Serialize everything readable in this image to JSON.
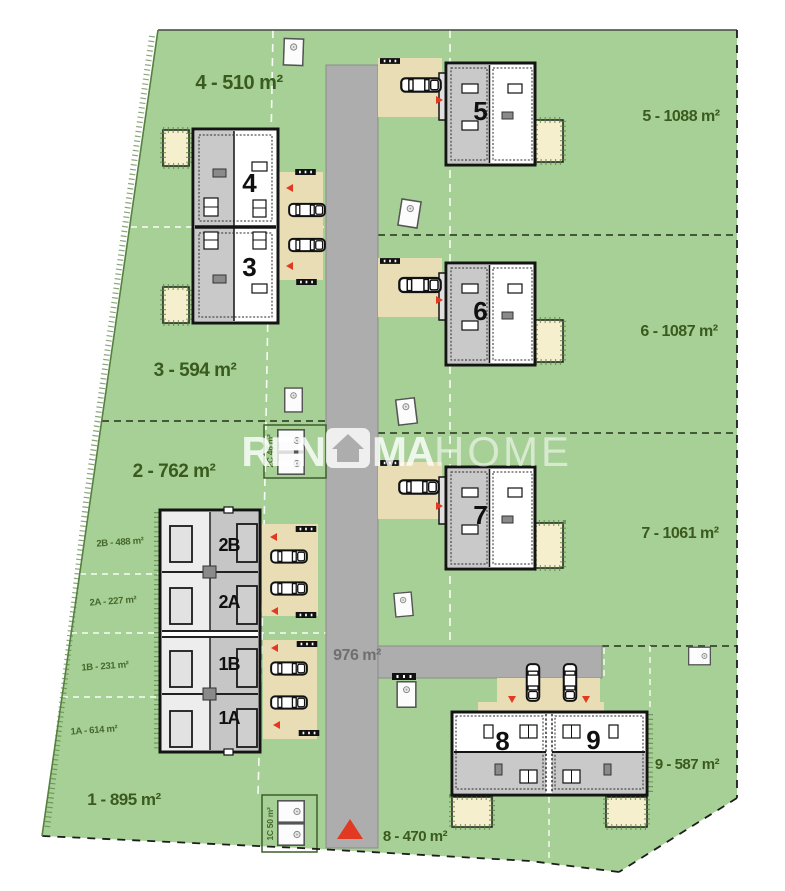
{
  "site": {
    "plots": {
      "p1": {
        "label": "1 - 895 m²"
      },
      "p2": {
        "label": "2 - 762 m²"
      },
      "p3": {
        "label": "3 - 594 m²"
      },
      "p4": {
        "label": "4 - 510 m²"
      },
      "p5": {
        "label": "5 - 1088 m²"
      },
      "p6": {
        "label": "6 - 1087 m²"
      },
      "p7": {
        "label": "7 - 1061 m²"
      },
      "p8": {
        "label": "8 - 470 m²"
      },
      "p9": {
        "label": "9 - 587 m²"
      }
    },
    "subplots": {
      "s2B": {
        "label": "2B - 488 m²"
      },
      "s2A": {
        "label": "2A - 227 m²"
      },
      "s1B": {
        "label": "1B - 231 m²"
      },
      "s1A": {
        "label": "1A - 614 m²"
      },
      "s2C": {
        "label": "2C 46 m²"
      },
      "s1C": {
        "label": "1C 50 m²"
      }
    },
    "road": {
      "area_label": "976 m²"
    },
    "buildings": {
      "b4": {
        "number": "4"
      },
      "b3": {
        "number": "3"
      },
      "b5": {
        "number": "5"
      },
      "b6": {
        "number": "6"
      },
      "b7": {
        "number": "7"
      },
      "b8": {
        "number": "8"
      },
      "b9": {
        "number": "9"
      },
      "u2B": {
        "number": "2B"
      },
      "u2A": {
        "number": "2A"
      },
      "u1B": {
        "number": "1B"
      },
      "u1A": {
        "number": "1A"
      }
    }
  },
  "watermark": {
    "bold_left": "REN",
    "bold_right": "MA",
    "light": "HOME"
  },
  "colors": {
    "grass": "#a7d097",
    "road": "#adadad",
    "driveway": "#e8ddb4",
    "patio": "#f6efcd",
    "building_gray": "#c9c9c9",
    "building_light": "#ffffff",
    "label_green": "#3b5a1e",
    "accent_red": "#e23a22",
    "boundary_black": "#1d1d1d"
  }
}
